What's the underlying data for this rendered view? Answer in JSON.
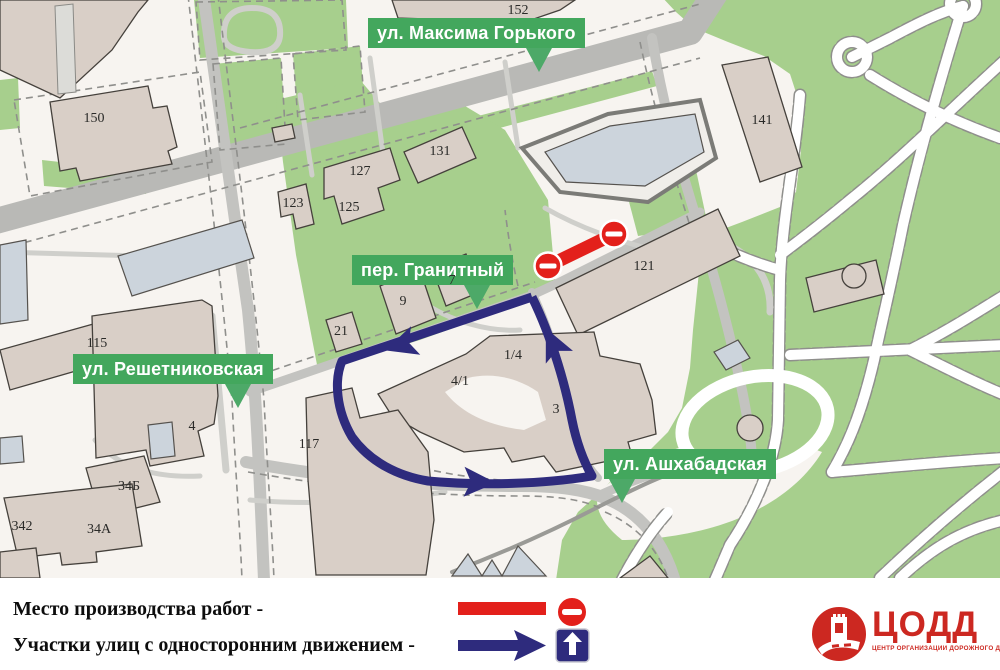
{
  "map": {
    "street_labels": [
      {
        "text": "ул. Максима Горького"
      },
      {
        "text": "пер. Гранитный"
      },
      {
        "text": "ул. Решетниковская"
      },
      {
        "text": "ул. Ашхабадская"
      }
    ],
    "building_labels": [
      {
        "label": "150"
      },
      {
        "label": "152"
      },
      {
        "label": "131"
      },
      {
        "label": "127"
      },
      {
        "label": "125"
      },
      {
        "label": "123"
      },
      {
        "label": "121"
      },
      {
        "label": "141"
      },
      {
        "label": "115"
      },
      {
        "label": "4"
      },
      {
        "label": "9"
      },
      {
        "label": "7"
      },
      {
        "label": "21"
      },
      {
        "label": "4/1"
      },
      {
        "label": "1/4"
      },
      {
        "label": "3"
      },
      {
        "label": "117"
      },
      {
        "label": "34Б"
      },
      {
        "label": "34А"
      },
      {
        "label": "342"
      }
    ]
  },
  "legend": {
    "items": [
      {
        "label": "Место производства работ -",
        "symbol": "red-closure-line",
        "sign": "no-entry"
      },
      {
        "label": "Участки улиц с односторонним движением -",
        "symbol": "blue-one-way-arrow",
        "sign": "one-way"
      }
    ]
  },
  "logo": {
    "title": "ЦОДД",
    "subtitle": "ЦЕНТР ОРГАНИЗАЦИИ ДОРОЖНОГО ДВИЖЕНИЯ"
  },
  "colors": {
    "map_background": "#f7f4f0",
    "green_area": "#a7cf8d",
    "road_gray": "#c3c3c0",
    "building_tan": "#d9cfc7",
    "building_bluegray": "#ccd4dc",
    "closure_red": "#e3201b",
    "one_way_blue": "#2e2b7d",
    "street_label_green": "#43a75d",
    "logo_red": "#cc2821"
  }
}
